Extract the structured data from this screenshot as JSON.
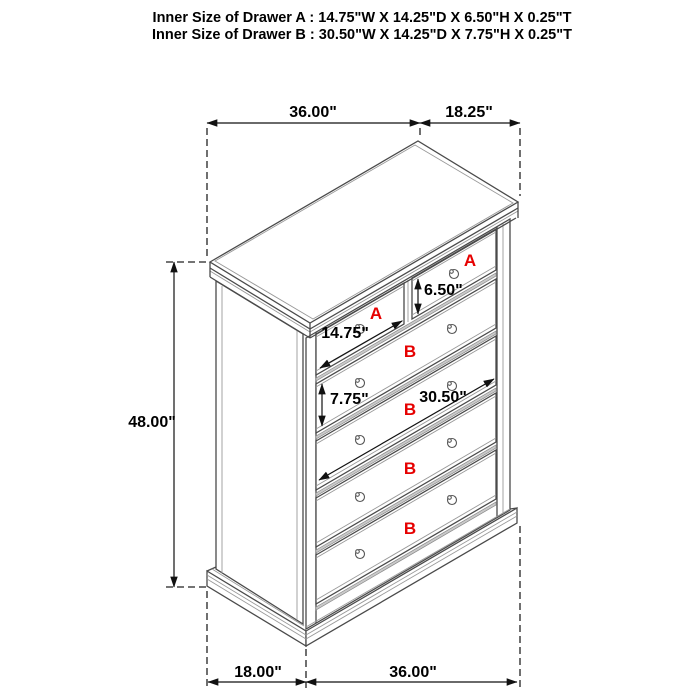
{
  "header": {
    "line_a": "Inner Size of Drawer A : 14.75\"W X 14.25\"D X 6.50\"H X 0.25\"T",
    "line_b": "Inner Size of Drawer B : 30.50\"W X 14.25\"D X 7.75\"H X 0.25\"T"
  },
  "dims": {
    "top_width": "36.00\"",
    "top_depth": "18.25\"",
    "height": "48.00\"",
    "bottom_depth": "18.00\"",
    "bottom_width": "36.00\""
  },
  "inner": {
    "a_height": "6.50\"",
    "a_width": "14.75\"",
    "b_height": "7.75\"",
    "b_width": "30.50\""
  },
  "drawers": [
    {
      "id": "A1",
      "label": "A",
      "type": "A"
    },
    {
      "id": "A2",
      "label": "A",
      "type": "A"
    },
    {
      "id": "B1",
      "label": "B",
      "type": "B"
    },
    {
      "id": "B2",
      "label": "B",
      "type": "B"
    },
    {
      "id": "B3",
      "label": "B",
      "type": "B"
    },
    {
      "id": "B4",
      "label": "B",
      "type": "B"
    }
  ],
  "colors": {
    "drawer_label": "#e60000",
    "line": "#4a4a4a",
    "dimension_text": "#000000",
    "background": "#ffffff"
  }
}
